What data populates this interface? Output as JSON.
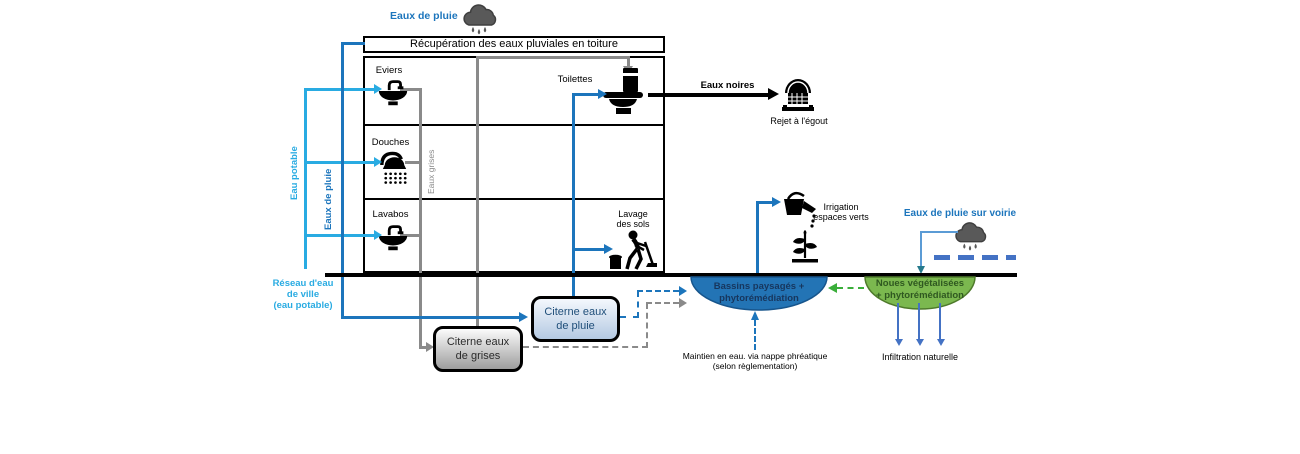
{
  "top": {
    "rain_label": "Eaux de pluie",
    "roof_box": "Récupération des eaux pluviales en toiture"
  },
  "building": {
    "eviers": "Eviers",
    "douches": "Douches",
    "lavabos": "Lavabos",
    "toilettes": "Toilettes",
    "lavage_line1": "Lavage",
    "lavage_line2": "des sols",
    "eaux_grises_vertical": "Eaux grises"
  },
  "supply": {
    "eau_potable_vertical": "Eau potable",
    "eaux_de_pluie_vertical": "Eaux de pluie",
    "reseau_line1": "Réseau d'eau",
    "reseau_line2": "de ville",
    "reseau_line3": "(eau potable)"
  },
  "sewer": {
    "eaux_noires": "Eaux noires",
    "rejet_egout": "Rejet à l'égout"
  },
  "tanks": {
    "pluie_line1": "Citerne eaux",
    "pluie_line2": "de pluie",
    "grises_line1": "Citerne eaux",
    "grises_line2": "de grises"
  },
  "outdoor": {
    "irrigation_line1": "Irrigation",
    "irrigation_line2": "espaces verts",
    "voirie_label": "Eaux de pluie sur voirie",
    "bassins_line1": "Bassins paysagés +",
    "bassins_line2": "phytorémédiation",
    "noues_line1": "Noues végétalisées",
    "noues_line2": "+ phytorémédiation",
    "maintien_line1": "Maintien en eau. via nappe phréatique",
    "maintien_line2": "(selon règlementation)",
    "infiltration": "Infiltration naturelle"
  },
  "colors": {
    "eau_potable": "#29ABE2",
    "eaux_de_pluie": "#1C75BC",
    "eaux_grises": "#8A8A8A",
    "eaux_noires": "#000000",
    "green_overflow": "#3AAE3A",
    "road_blue": "#4472C4",
    "voirie_line": "#5B9BD5",
    "voirie_arrow": "#267A8C",
    "basin_fill": "#2374B5",
    "basin_text": "#17365D",
    "swale_fill": "#7BB84F",
    "swale_text": "#2F5820"
  },
  "icons": {
    "cloud_top": "rain-cloud",
    "cloud_voirie": "rain-cloud",
    "sink": "sink-faucet",
    "shower": "shower-head",
    "toilet": "toilet",
    "mop": "person-mopping",
    "watering_can": "watering-can",
    "plant": "plant",
    "sewer": "sewer-drain"
  }
}
